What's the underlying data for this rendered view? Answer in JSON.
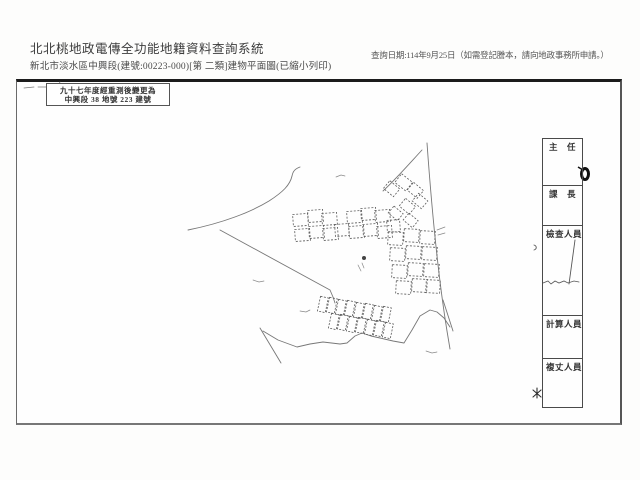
{
  "header": {
    "system_title": "北北桃地政電傳全功能地籍資料查詢系統",
    "document_title": "新北市淡水區中興段(建號:00223-000)[第 二類]建物平面圖(已縮小列印)",
    "query_date_note": "查詢日期:114年9月25日（如需登記謄本，請向地政事務所申請。）"
  },
  "annotation_box": {
    "line1": "九十七年度經重測後變更為",
    "line2": "中興段 38 地號 223 建號"
  },
  "signature_column": {
    "roles": [
      {
        "label": "主　任"
      },
      {
        "label": "課　長"
      },
      {
        "label": "檢查人員"
      },
      {
        "label": "計算人員"
      },
      {
        "label": "複丈人員"
      }
    ]
  },
  "colors": {
    "paper": "#fdfdfc",
    "ink": "#3a3a3a",
    "frame_border": "#1c1c1c",
    "sketch_line": "#777777",
    "seal": "#111111"
  }
}
